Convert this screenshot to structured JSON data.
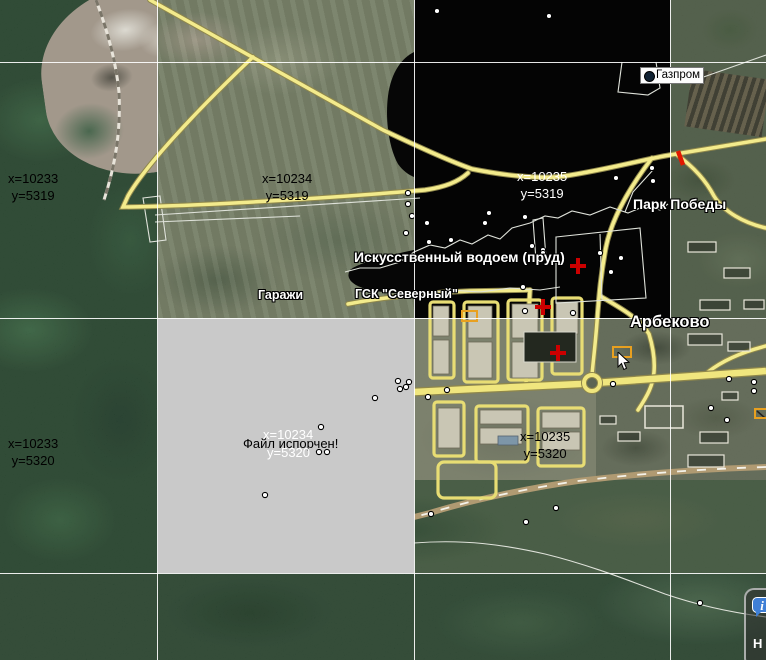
{
  "map": {
    "grid": {
      "vertical_lines": [
        157,
        414,
        670
      ],
      "horizontal_lines": [
        62,
        318,
        573
      ]
    },
    "tile_labels": [
      {
        "x_text": "x=10233",
        "y_text": "y=5319",
        "px": 8,
        "py": 170,
        "color": "#000000"
      },
      {
        "x_text": "x=10234",
        "y_text": "y=5319",
        "px": 262,
        "py": 170,
        "color": "#000000"
      },
      {
        "x_text": "x=10235",
        "y_text": "y=5319",
        "px": 517,
        "py": 168,
        "color": "#ffffff"
      },
      {
        "x_text": "x=10233",
        "y_text": "y=5320",
        "px": 8,
        "py": 435,
        "color": "#000000"
      },
      {
        "x_text": "x=10235",
        "y_text": "y=5320",
        "px": 520,
        "py": 428,
        "color": "#000000"
      }
    ],
    "corrupt_tile": {
      "error_text": "Файл испорчен!",
      "x_text": "x=10234",
      "y_text": "y=5320",
      "tile_color": "#c9c9c9"
    },
    "place_labels": [
      {
        "id": "pond",
        "text": "Искусственный водоем (пруд)",
        "px": 354,
        "py": 249,
        "size": 14
      },
      {
        "id": "garages",
        "text": "Гаражи",
        "px": 258,
        "py": 288,
        "size": 12.5
      },
      {
        "id": "gsk-severny",
        "text": "ГСК \"Северный\"",
        "px": 355,
        "py": 287,
        "size": 12.5
      },
      {
        "id": "park-pobedy",
        "text": "Парк Победы",
        "px": 633,
        "py": 196,
        "size": 14
      },
      {
        "id": "arbekovo",
        "text": "Арбеково",
        "px": 630,
        "py": 313,
        "size": 16.5
      }
    ],
    "poi_label": {
      "text": "Газпром",
      "px": 640,
      "py": 67
    },
    "markers": {
      "poi_dots": [
        [
          437,
          11
        ],
        [
          549,
          16
        ],
        [
          408,
          193
        ],
        [
          408,
          204
        ],
        [
          412,
          216
        ],
        [
          406,
          233
        ],
        [
          427,
          223
        ],
        [
          429,
          242
        ],
        [
          451,
          240
        ],
        [
          485,
          223
        ],
        [
          489,
          213
        ],
        [
          525,
          217
        ],
        [
          532,
          246
        ],
        [
          543,
          250
        ],
        [
          545,
          258
        ],
        [
          523,
          287
        ],
        [
          525,
          311
        ],
        [
          543,
          253
        ],
        [
          616,
          178
        ],
        [
          652,
          168
        ],
        [
          653,
          181
        ],
        [
          600,
          253
        ],
        [
          611,
          272
        ],
        [
          621,
          258
        ],
        [
          573,
          313
        ],
        [
          613,
          384
        ],
        [
          398,
          381
        ],
        [
          406,
          387
        ],
        [
          375,
          398
        ],
        [
          321,
          427
        ],
        [
          319,
          452
        ],
        [
          327,
          452
        ],
        [
          265,
          495
        ],
        [
          409,
          382
        ],
        [
          400,
          389
        ],
        [
          428,
          397
        ],
        [
          447,
          390
        ],
        [
          729,
          379
        ],
        [
          754,
          382
        ],
        [
          754,
          391
        ],
        [
          711,
          408
        ],
        [
          727,
          420
        ],
        [
          431,
          514
        ],
        [
          526,
          522
        ],
        [
          556,
          508
        ],
        [
          700,
          603
        ]
      ],
      "red_crosses": [
        [
          578,
          266
        ],
        [
          543,
          307
        ],
        [
          558,
          353
        ]
      ],
      "selection_boxes": [
        [
          462,
          311,
          15,
          10
        ],
        [
          613,
          347,
          18,
          10
        ],
        [
          755,
          409,
          12,
          9
        ]
      ],
      "traffic_segment": {
        "x1": 678,
        "y1": 151,
        "x2": 683,
        "y2": 165,
        "color": "#e01800"
      }
    },
    "colors": {
      "road_major": "#f3eb8c",
      "grid_line": "#ffffff",
      "marker_red": "#cc0000",
      "water": "#040404",
      "corrupt_tile_gray": "#c9c9c9"
    }
  },
  "cursor": {
    "px": 617,
    "py": 352
  },
  "controls": {
    "info_button": {
      "glyph": "i",
      "label": "Н",
      "balloon_color": "#3f7fd6"
    }
  }
}
